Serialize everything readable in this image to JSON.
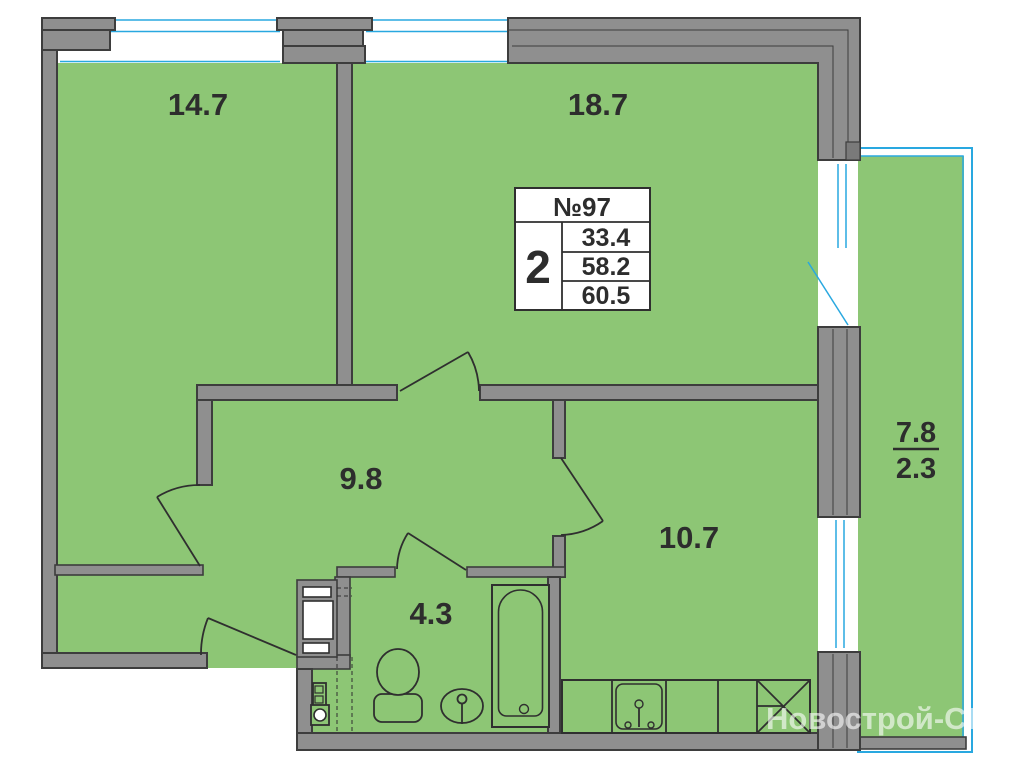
{
  "floorplan": {
    "watermark": "Новострой-СПб",
    "info_box": {
      "unit_label": "№97",
      "rooms_count": "2",
      "area_rows": [
        "33.4",
        "58.2",
        "60.5"
      ]
    },
    "room_labels": {
      "living_room": "14.7",
      "bedroom": "18.7",
      "hallway": "9.8",
      "kitchen": "10.7",
      "bathroom": "4.3",
      "balcony_total": "7.8",
      "balcony_reduced": "2.3"
    },
    "colors": {
      "room_fill": "#8DC675",
      "wall_fill": "#8F8F8F",
      "outline_dark": "#3D3D3D",
      "glazing_blue": "#29A8E0",
      "label_text": "#2D2D2D"
    }
  }
}
